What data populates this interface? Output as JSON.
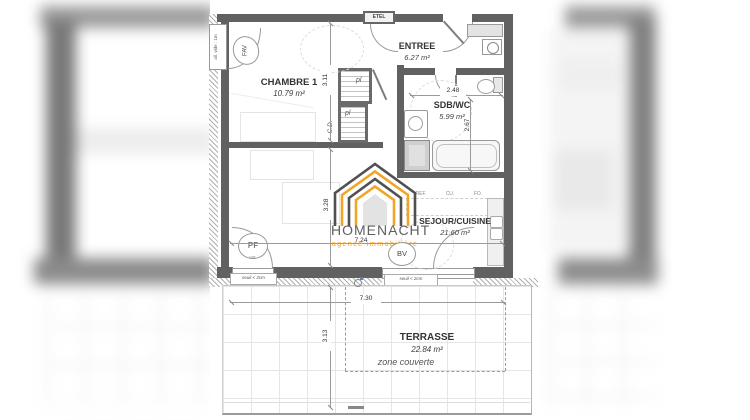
{
  "logo": {
    "name": "HOMENACHT",
    "tagline": "agence immobilière",
    "accent_color": "#EFA11B",
    "dark_color": "#4A4A4A"
  },
  "rooms": {
    "chambre": {
      "name": "CHAMBRE 1",
      "area": "10.79 m²"
    },
    "entree": {
      "name": "ENTREE",
      "area": "6.27 m²"
    },
    "sdb": {
      "name": "SDB/WC",
      "area": "5.99 m²"
    },
    "sejour": {
      "name": "SEJOUR/CUISINE",
      "area": "21.60 m²"
    },
    "terrasse": {
      "name": "TERRASSE",
      "area": "22.84 m²",
      "note": "zone couverte"
    }
  },
  "dimensions": {
    "chambre_height": "3.11",
    "sejour_height": "3.28",
    "sejour_width": "7.24",
    "sdb_width": "2.48",
    "sdb_height": "2.67",
    "terrasse_width": "7.30",
    "terrasse_height": "3.13"
  },
  "labels": {
    "etel": "ETEL",
    "fav": "FAV",
    "pf": "PF",
    "bv": "BV",
    "vr_pf": "VR",
    "vr_bv": "VR",
    "pl_upper": "pl",
    "pl_lower": "pl",
    "cd": "C.D.",
    "ref": "REF.",
    "cu": "CU.",
    "fo": "FO.",
    "seuil_pf": "seuil < 2cm",
    "seuil_bv": "seuil < 2cm",
    "all_vide": "all. vide : 1m"
  },
  "colors": {
    "wall": "#5f5f5f",
    "accent": "#EFA11B",
    "dim_line": "#9a9a9a"
  }
}
